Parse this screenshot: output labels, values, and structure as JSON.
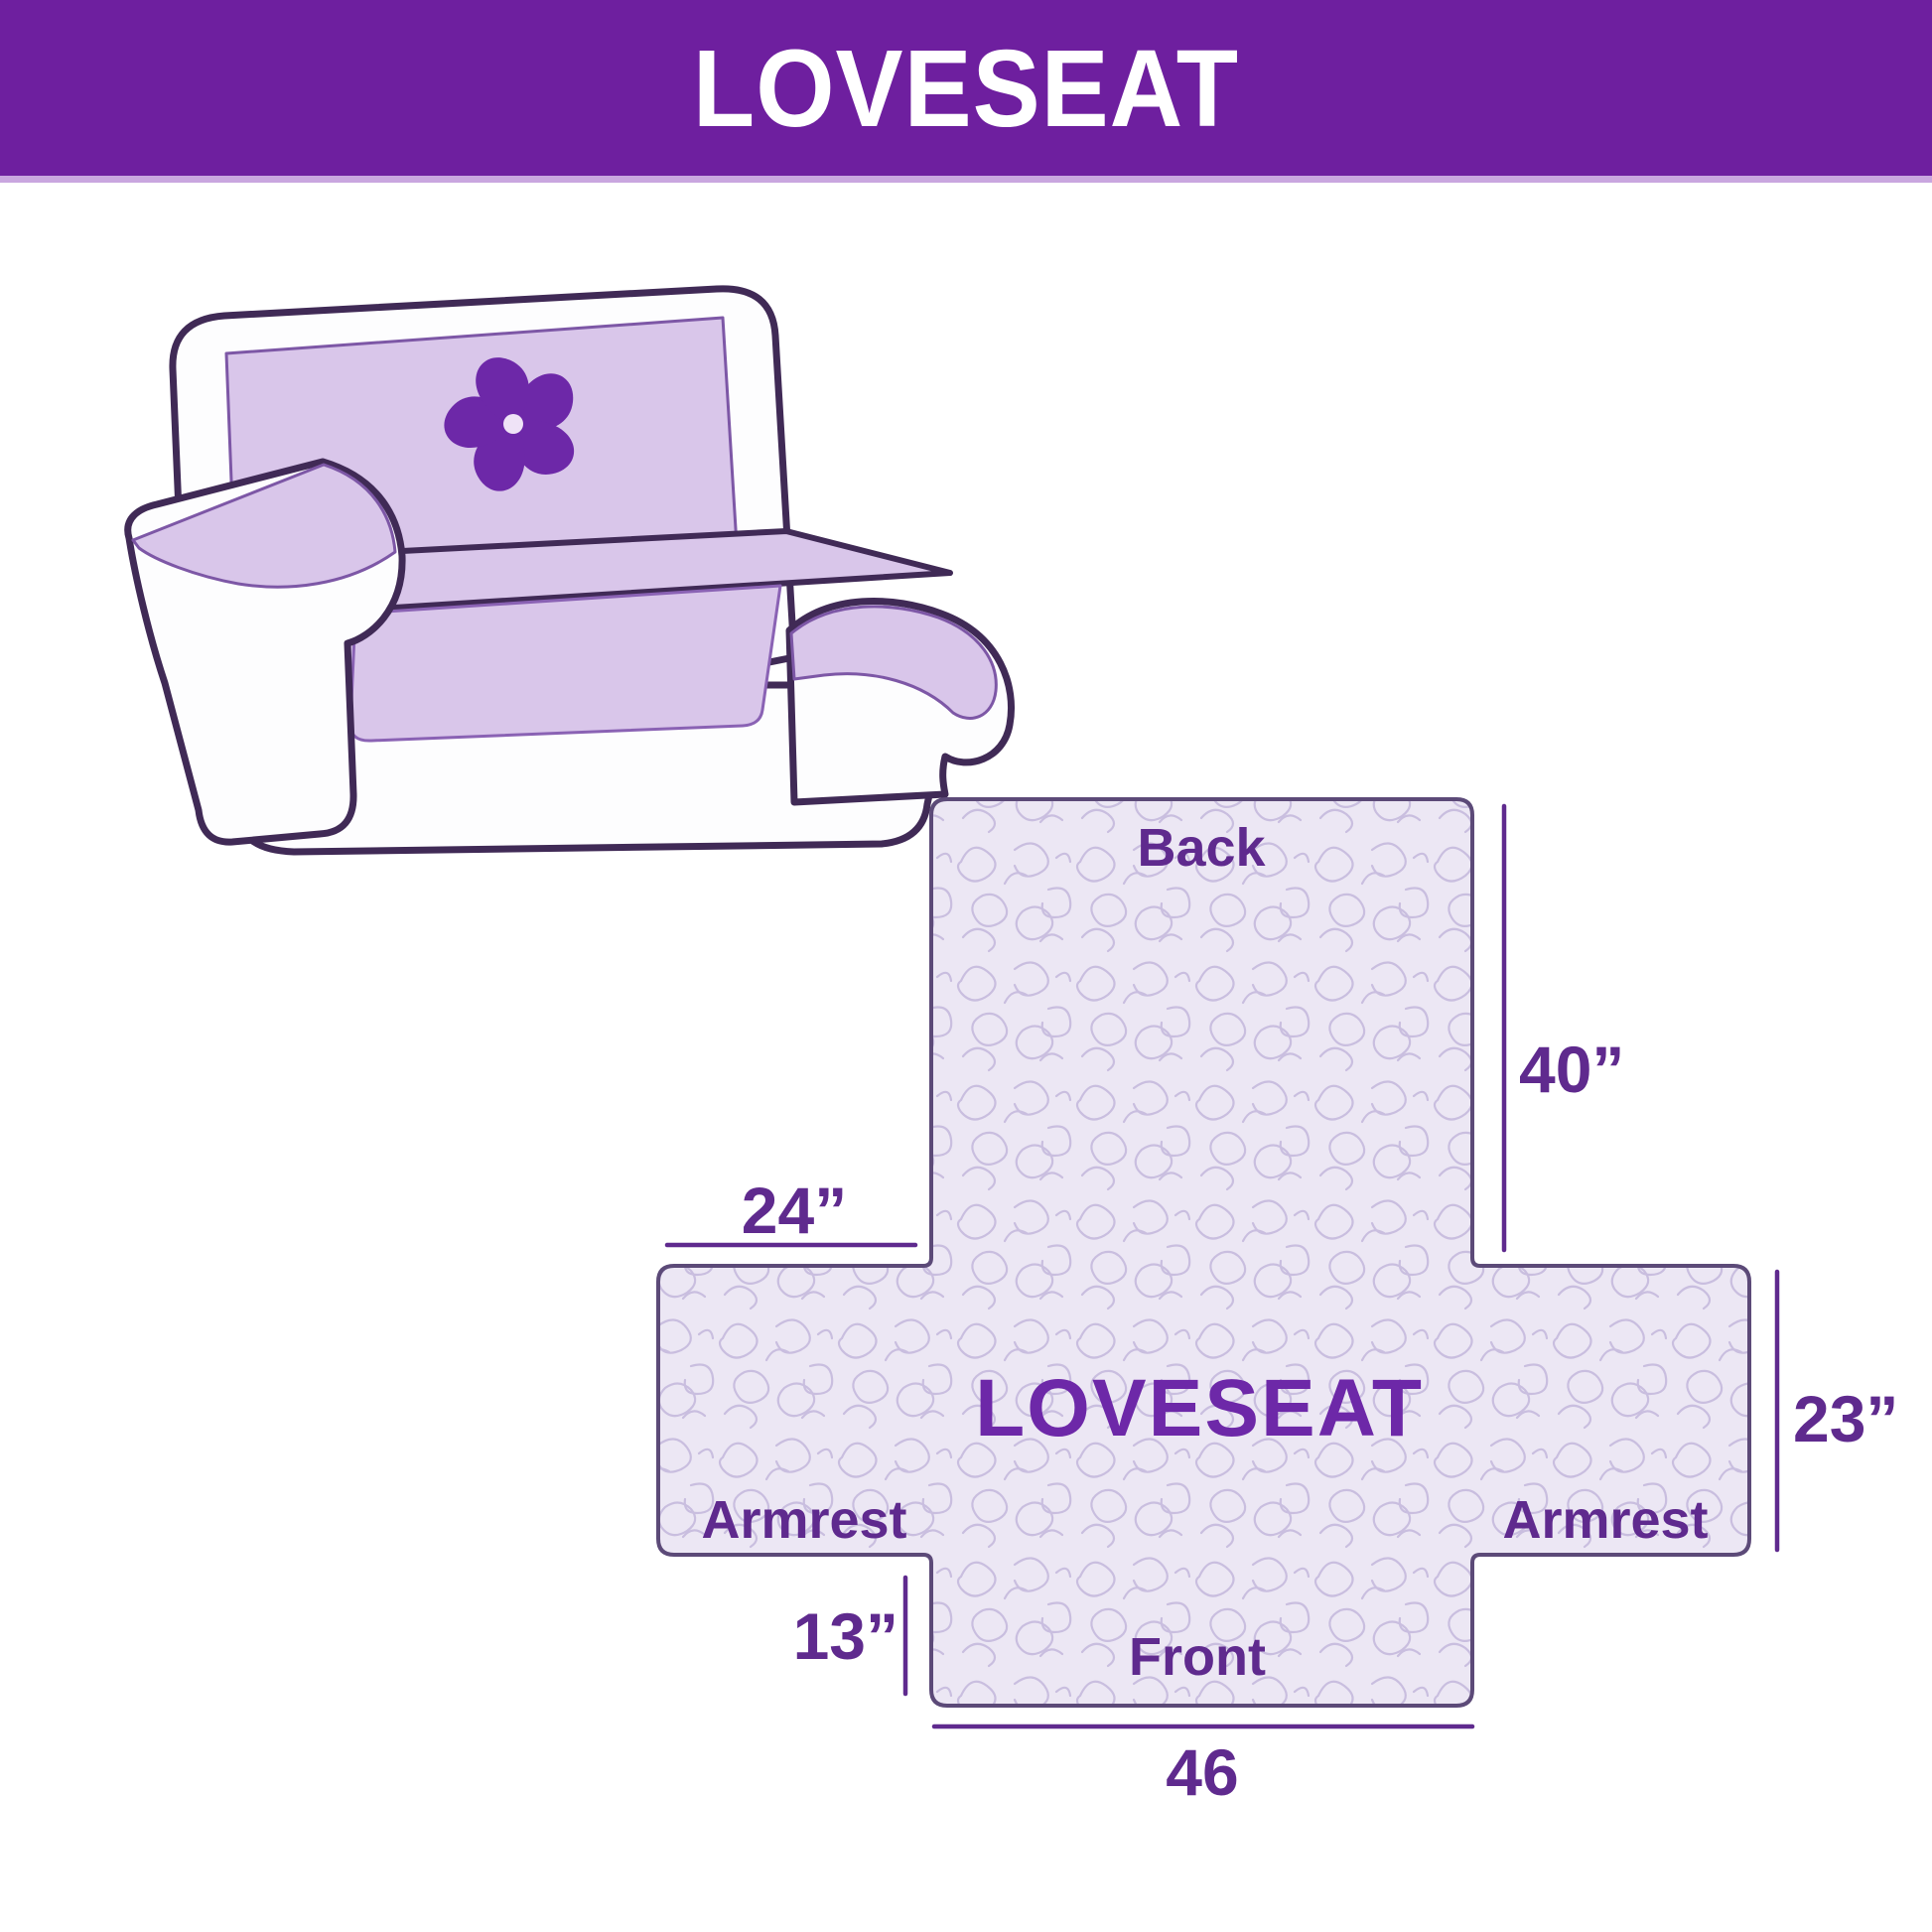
{
  "header": {
    "title": "LOVESEAT"
  },
  "sofa": {
    "description": "hand-drawn loveseat with quilted slipcover",
    "logo": "pinwheel-flower"
  },
  "diagram": {
    "center_label": "LOVESEAT",
    "back_label": "Back",
    "front_label": "Front",
    "armrest_left_label": "Armrest",
    "armrest_right_label": "Armrest",
    "dim_back_height": "40”",
    "dim_armrest_depth": "24”",
    "dim_side_height": "23”",
    "dim_front_drop": "13”",
    "dim_front_width": "46"
  },
  "colors": {
    "header_bg": "#6e1f9f",
    "header_strip": "#c9a6df",
    "label_text": "#5f2a8e",
    "center_text": "#6d28a8",
    "sofa_outline": "#402a56",
    "sofa_cover": "#d9c6ea",
    "pinwheel": "#6d28a8",
    "pattern_bg": "#ece7f4",
    "pattern_line": "#c9bedf",
    "shape_outline": "#5c4a78"
  }
}
